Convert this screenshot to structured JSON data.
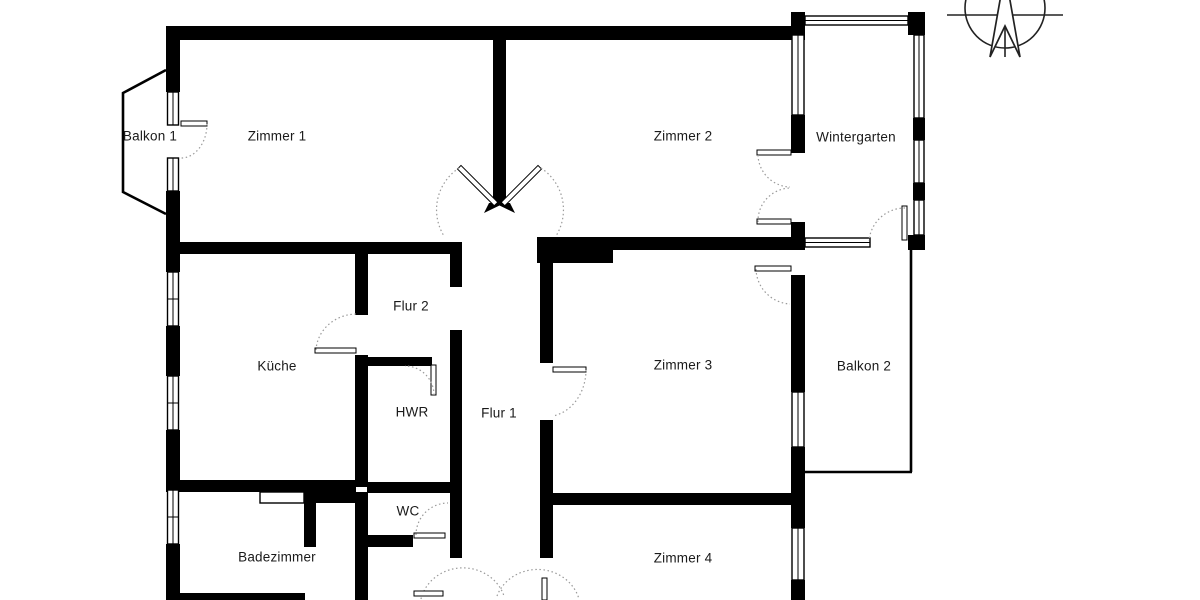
{
  "meta": {
    "type": "floor-plan",
    "background_color": "#ffffff",
    "wall_color": "#000000",
    "label_color": "#1a1a1a",
    "door_arc_color": "#9a9a9a"
  },
  "rooms": [
    {
      "label": "Balkon 1"
    },
    {
      "label": "Zimmer 1"
    },
    {
      "label": "Zimmer 2"
    },
    {
      "label": "Wintergarten"
    },
    {
      "label": "Flur 2"
    },
    {
      "label": "Küche"
    },
    {
      "label": "HWR"
    },
    {
      "label": "Flur 1"
    },
    {
      "label": "Zimmer 3"
    },
    {
      "label": "Balkon 2"
    },
    {
      "label": "WC"
    },
    {
      "label": "Badezimmer"
    },
    {
      "label": "Zimmer 4"
    }
  ],
  "icons": {
    "compass": "north-arrow"
  }
}
